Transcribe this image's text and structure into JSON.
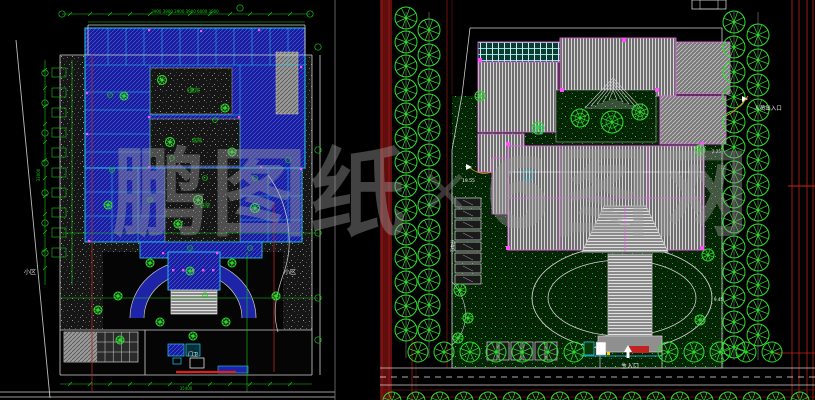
{
  "window": {
    "background": "#000000"
  },
  "watermark": {
    "prefix": "鹏图纸",
    "separator": "×",
    "suffix": "6图网"
  },
  "left_plan": {
    "labels": {
      "dims_top": "3900 3900 3900 3900 6000 3900",
      "side_dim": "33000",
      "bottom_dim": "35400",
      "gate": "门卫",
      "district_left": "小区",
      "district_right": "小区",
      "court1": "庭院",
      "court2": "庭院",
      "court3": "庭院"
    }
  },
  "right_plan": {
    "labels": {
      "person_entrance": "人员出入口",
      "main_entrance": "主入口",
      "elevation": "19.55",
      "parking": "停车位",
      "dim_a": "2.25",
      "dim_b": "9.45"
    }
  },
  "colors": {
    "blue_room": "#161b96",
    "blue_hatch": "#4c57e8",
    "blue_road": "#1d24a8",
    "cyan_wall": "#22c8f0",
    "green_dim": "#18c918",
    "tree_green": "#2de02d",
    "magenta": "#ff50ff",
    "magenta_soft": "#e060e0",
    "red_line": "#cc2020",
    "red_bright": "#e02020",
    "dark_red": "#5f0d0d",
    "red_band_line": "#a32020",
    "roof_gray": "#6f6f6f",
    "lawn": "#062406",
    "white_line": "#cfcfcf",
    "orange": "#e8a020"
  }
}
